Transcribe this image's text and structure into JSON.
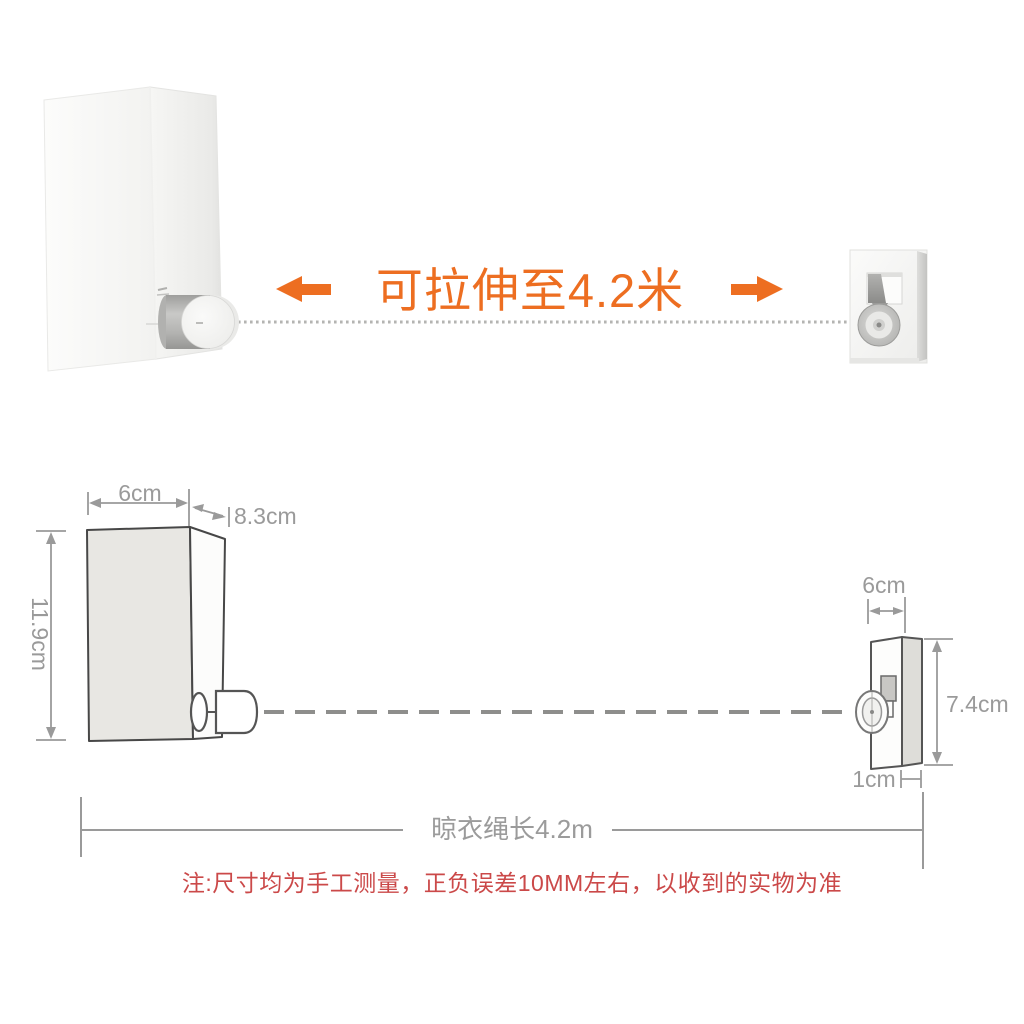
{
  "top_section": {
    "headline": "可拉伸至4.2米",
    "icons": [
      "stretch-arrow-left",
      "stretch-arrow-right"
    ],
    "rope_style": "dotted-bead-line"
  },
  "dimension_diagram": {
    "device": {
      "width_label": "6cm",
      "depth_label": "8.3cm",
      "height_label": "11.9cm"
    },
    "bracket": {
      "width_label": "6cm",
      "height_label": "7.4cm",
      "depth_label": "1cm"
    },
    "rope_length_label": "晾衣绳长4.2m"
  },
  "note_text": "注:尺寸均为手工测量，正负误差10MM左右，以收到的实物为准",
  "colors": {
    "accent_orange": "#ED6E21",
    "note_red": "#CB4949",
    "dimension_gray": "#9A9A9A",
    "outline_dark": "#4A4A4A",
    "rope_gray": "#8E8E8C"
  }
}
